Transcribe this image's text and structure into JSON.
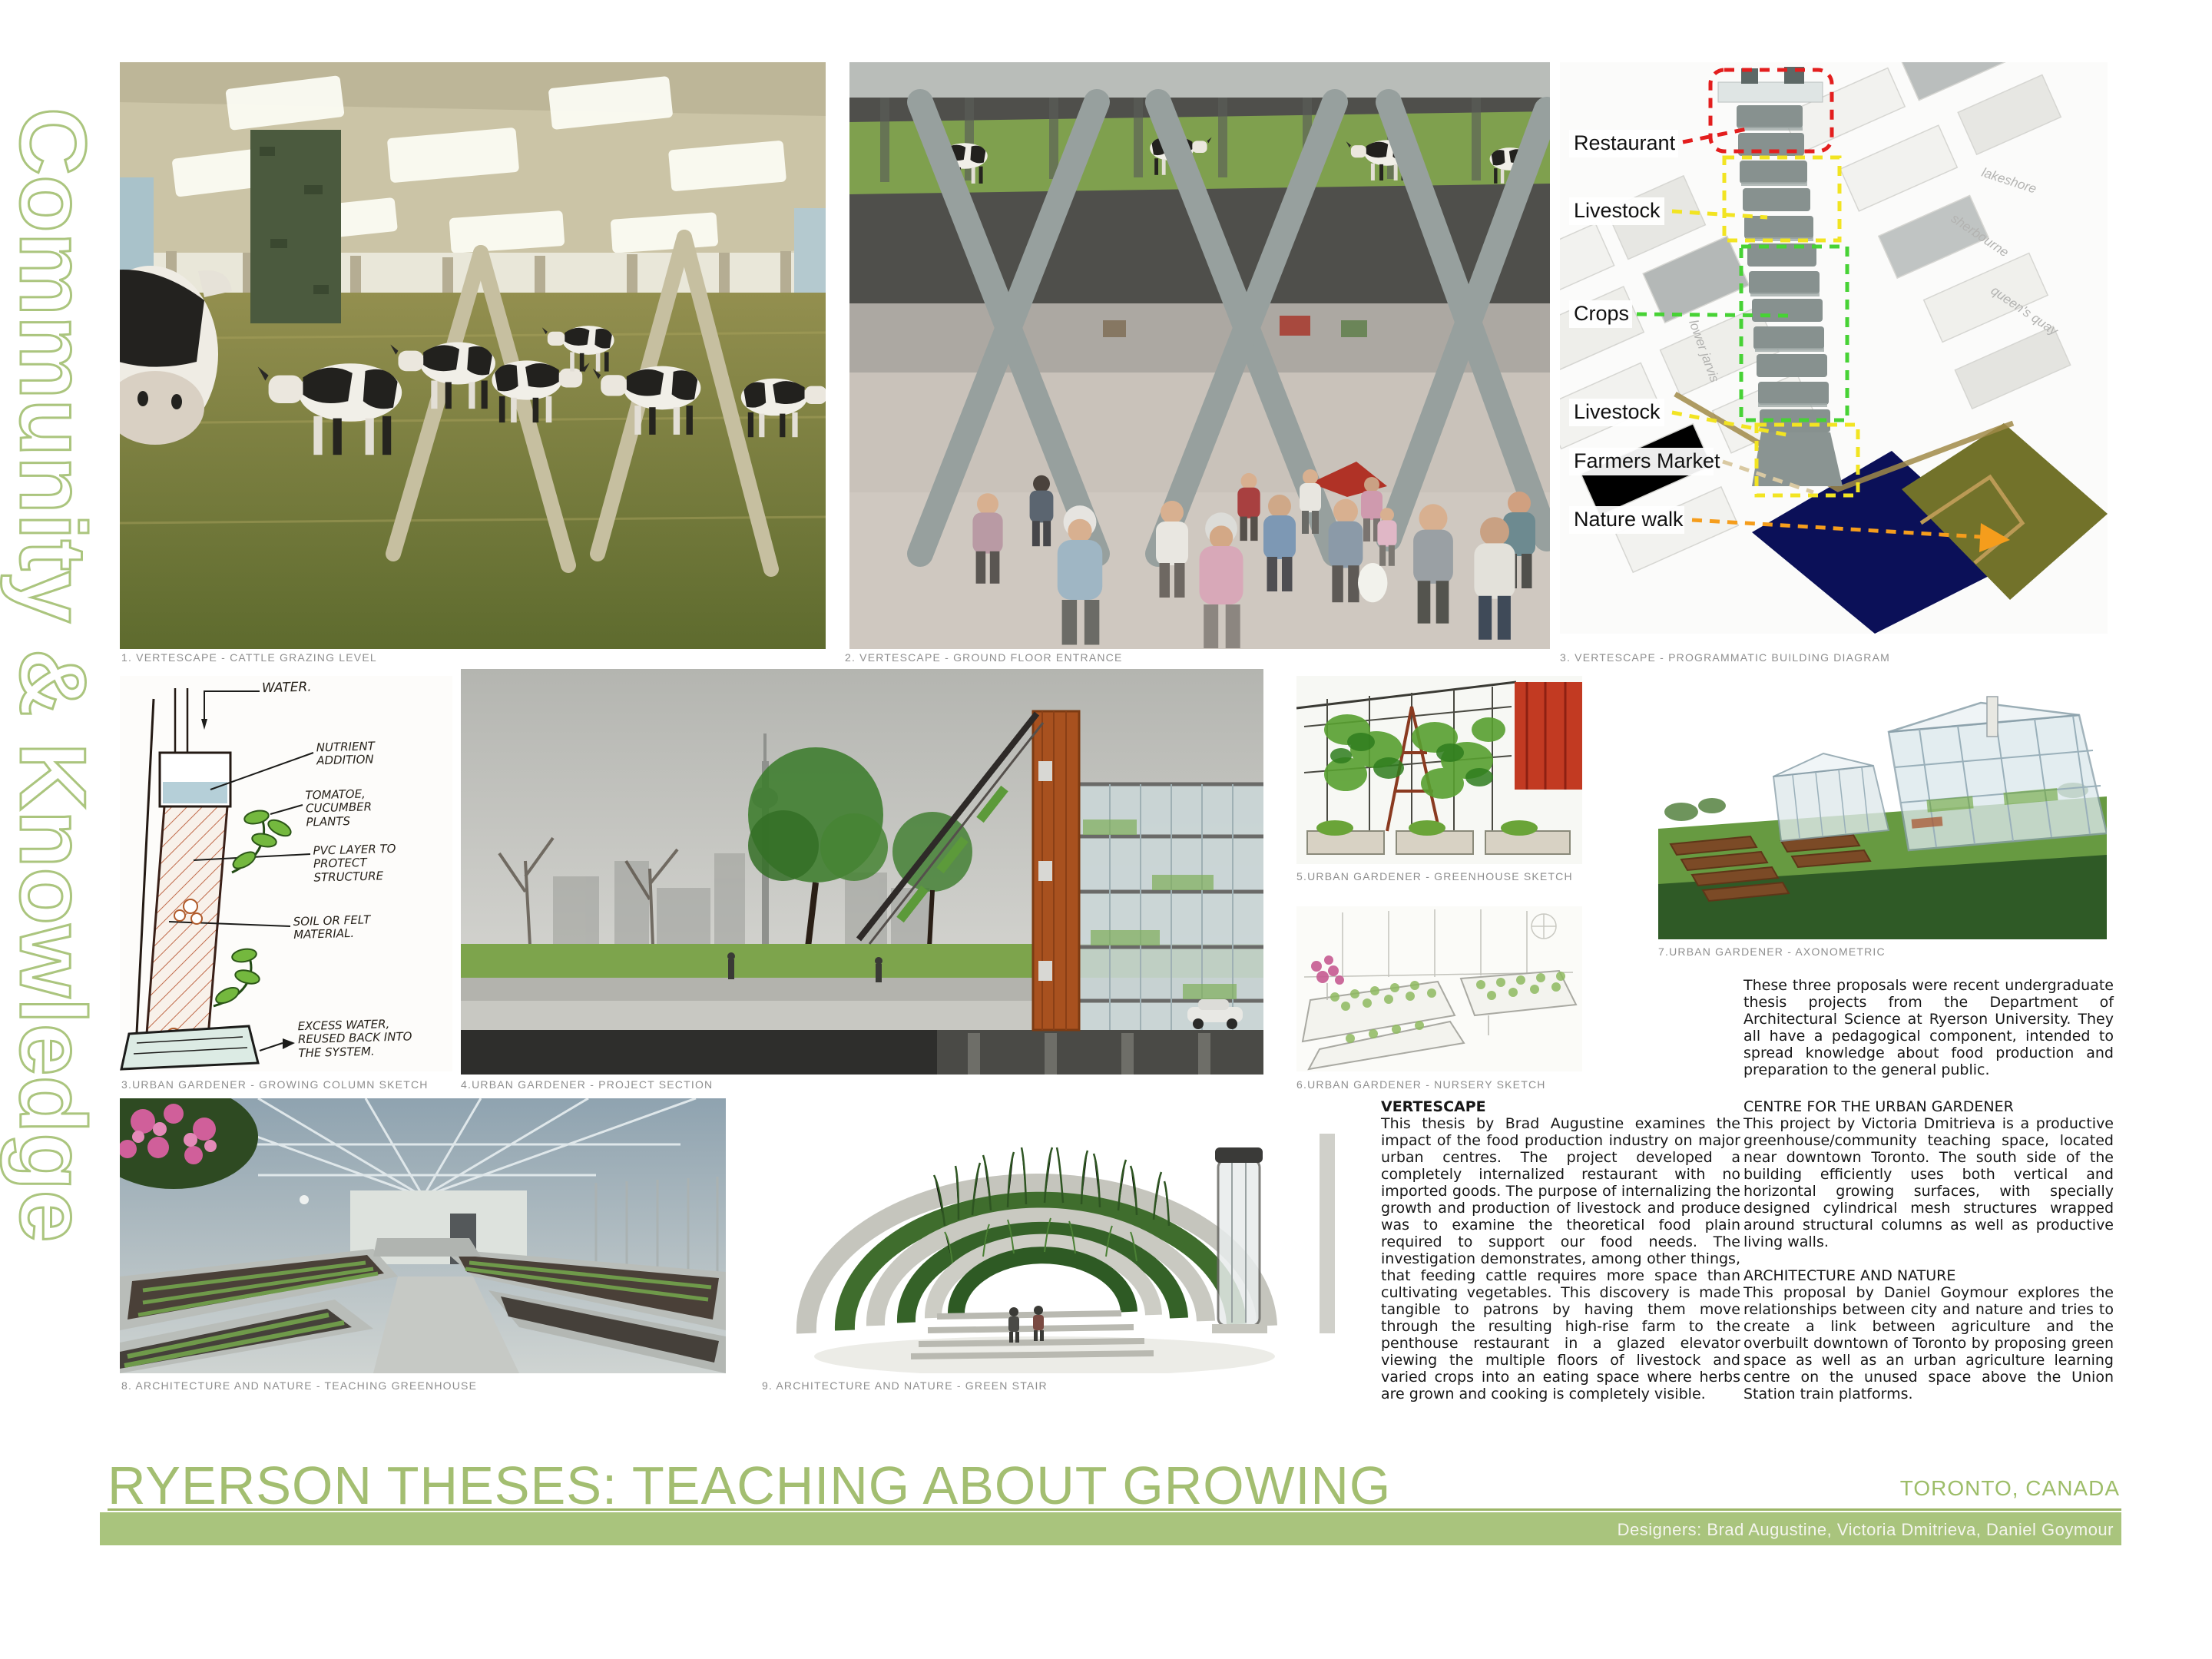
{
  "page": {
    "side_label": "Community & Knowledge",
    "title": "RYERSON THESES: TEACHING ABOUT GROWING",
    "location": "TORONTO, CANADA",
    "designers": "Designers: Brad Augustine, Victoria Dmitrieva, Daniel Goymour"
  },
  "colors": {
    "accent_green": "#a9c47d",
    "title_green": "#a3be71",
    "caption_grey": "#8e8e8e",
    "water_navy": "#0b1058",
    "park_olive": "#72722a"
  },
  "captions": [
    "1. VERTESCAPE -  CATTLE GRAZING LEVEL",
    "2. VERTESCAPE -  GROUND FLOOR ENTRANCE",
    "3. VERTESCAPE -  PROGRAMMATIC BUILDING DIAGRAM",
    "3.URBAN GARDENER - GROWING COLUMN SKETCH",
    "4.URBAN GARDENER - PROJECT SECTION",
    "5.URBAN GARDENER - GREENHOUSE SKETCH",
    "6.URBAN GARDENER - NURSERY SKETCH",
    "7.URBAN GARDENER - AXONOMETRIC",
    "8. ARCHITECTURE AND NATURE - TEACHING GREENHOUSE",
    "9. ARCHITECTURE AND NATURE - GREEN STAIR"
  ],
  "diagram": {
    "labels": [
      {
        "text": "Restaurant",
        "color": "#e31e1e"
      },
      {
        "text": "Livestock",
        "color": "#f2e422"
      },
      {
        "text": "Crops",
        "color": "#47d235"
      },
      {
        "text": "Livestock",
        "color": "#f2e422"
      },
      {
        "text": "Farmers Market",
        "color": "#d9c9a2"
      },
      {
        "text": "Nature walk",
        "color": "#f59d1c"
      }
    ],
    "streets": [
      "lakeshore",
      "sherbourne",
      "queen's quay",
      "lower jarvis"
    ]
  },
  "sketch": {
    "annotations": [
      "WATER.",
      "NUTRIENT ADDITION",
      "TOMATOE, CUCUMBER PLANTS",
      "PVC LAYER TO PROTECT STRUCTURE",
      "SOIL OR FELT MATERIAL.",
      "EXCESS WATER, REUSED BACK INTO THE SYSTEM."
    ]
  },
  "text": {
    "intro": "These three proposals were recent undergraduate thesis projects from the Department of Architectural Science at Ryerson University.  They all have a pedagogical component, intended to spread knowledge about food production and preparation to the general public.",
    "sections": [
      {
        "heading": "VERTESCAPE",
        "body": "This thesis by Brad Augustine examines the impact of the food production industry on major urban centres.  The project developed a completely internalized restaurant with no imported goods.  The purpose of internalizing the growth and production of livestock and produce was to examine the theoretical food plain required to support our food needs.  The investigation demonstrates, among other things, that feeding cattle requires more space than cultivating vegetables.  This discovery is made tangible to patrons by having them move through the resulting high-rise farm to the penthouse restaurant in a glazed elevator viewing the multiple floors of livestock and varied crops into an eating space where herbs are grown and cooking is completely visible."
      },
      {
        "heading": "CENTRE FOR THE URBAN GARDENER",
        "body": "This project by Victoria Dmitrieva is a productive greenhouse/community teaching space, located near downtown Toronto. The south side of the building efficiently uses both vertical and horizontal growing surfaces, with specially designed cylindrical mesh structures wrapped around structural columns as well as  productive living walls."
      },
      {
        "heading": "ARCHITECTURE AND NATURE",
        "body": "This proposal by Daniel Goymour explores the relationships between city and nature and tries to create a link between agriculture and the overbuilt downtown of Toronto by proposing green space as well as an urban agriculture learning centre on the unused space above the Union Station train platforms."
      }
    ]
  }
}
